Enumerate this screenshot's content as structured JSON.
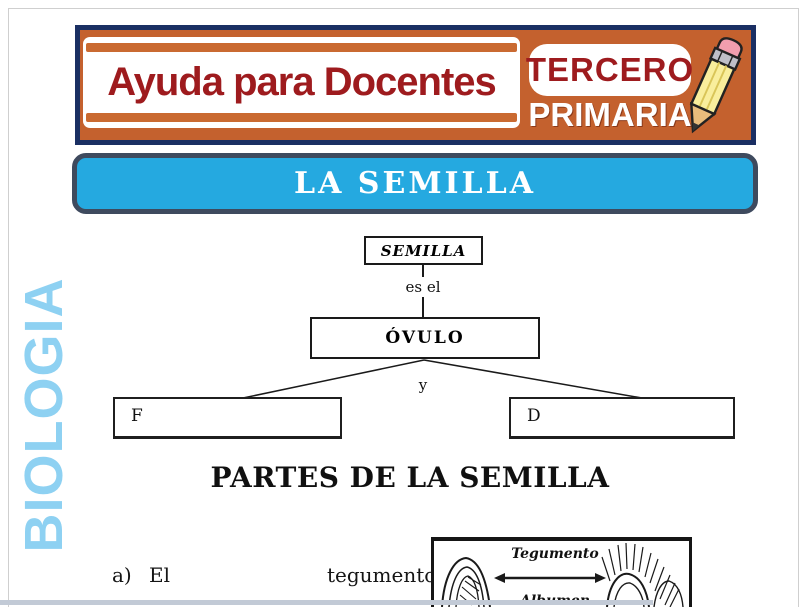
{
  "sidebar": {
    "subject": "BIOLOGIA"
  },
  "header": {
    "brand": "Ayuda para Docentes",
    "grade": {
      "line1": "TERCERO",
      "line2": "PRIMARIA"
    },
    "colors": {
      "background": "#c4612e",
      "border": "#1a2f63",
      "text_red": "#9e1b1e"
    }
  },
  "title_bar": {
    "title": "LA SEMILLA",
    "colors": {
      "background": "#25a9e0",
      "border": "#3e4a5e",
      "text": "#ffffff"
    }
  },
  "concept_map": {
    "root_label": "SEMILLA",
    "connector_top": "es el",
    "middle_label": "ÓVULO",
    "connector_bottom": "y",
    "left_box_text": "F",
    "right_box_text": "D"
  },
  "section_heading": "PARTES DE LA SEMILLA",
  "paragraph": {
    "marker": "a)",
    "word_1": "El",
    "word_2": "tegumento,"
  },
  "figure": {
    "label_top": "Tegumento",
    "label_bottom": "Albumen"
  },
  "accent_colors": {
    "sidebar_text": "#8ed1f2",
    "stripe_orange": "#ca6a31"
  }
}
